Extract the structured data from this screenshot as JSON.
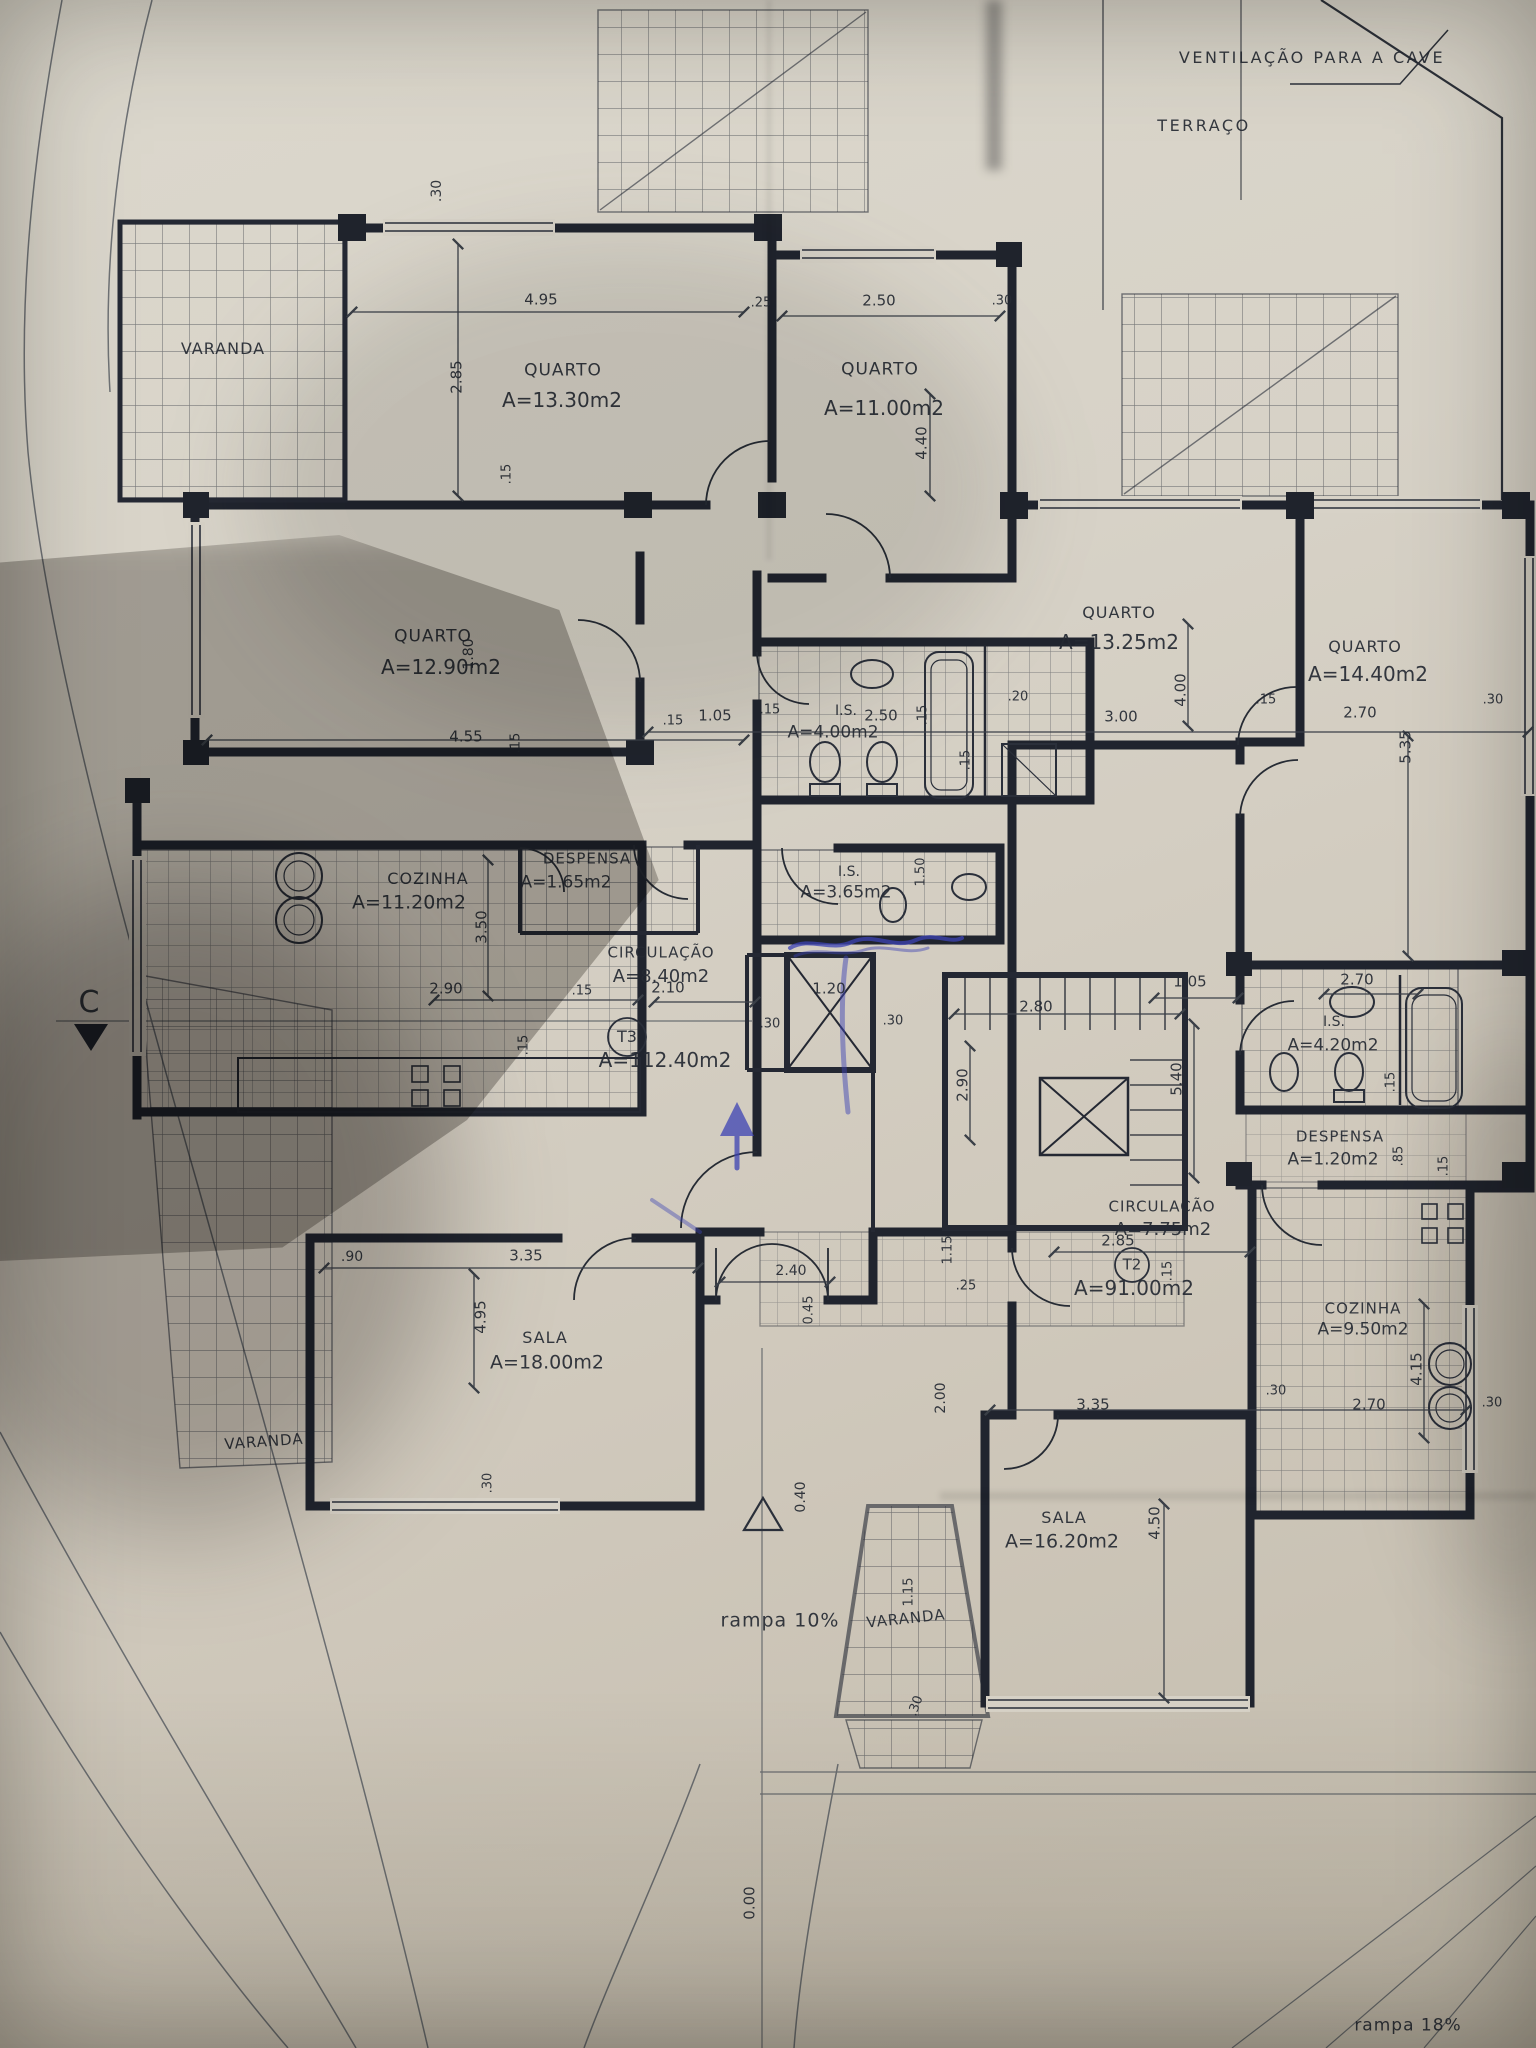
{
  "plan_summary": {
    "site_notes": [
      "VENTILAÇÃO PARA A CAVE",
      "TERRAÇO",
      "rampa 10%",
      "rampa 18%"
    ],
    "levels": [
      "0.40",
      "0.00"
    ],
    "section_marker": "C",
    "ink_annotation_color": "#3d43b4",
    "apartments": [
      {
        "tag": "T3",
        "total_area_m2": "112.40",
        "rooms": [
          {
            "name": "QUARTO",
            "area_m2": "13.30"
          },
          {
            "name": "QUARTO",
            "area_m2": "11.00"
          },
          {
            "name": "QUARTO",
            "area_m2": "12.90"
          },
          {
            "name": "COZINHA",
            "area_m2": "11.20"
          },
          {
            "name": "DESPENSA",
            "area_m2": "1.65"
          },
          {
            "name": "CIRCULAÇÃO",
            "area_m2": "8.40"
          },
          {
            "name": "I.S.",
            "area_m2": "4.00"
          },
          {
            "name": "I.S.",
            "area_m2": "3.65"
          },
          {
            "name": "SALA",
            "area_m2": "18.00"
          },
          {
            "name": "VARANDA",
            "area_m2": ""
          },
          {
            "name": "VARANDA",
            "area_m2": ""
          }
        ]
      },
      {
        "tag": "T2",
        "total_area_m2": "91.00",
        "rooms": [
          {
            "name": "QUARTO",
            "area_m2": "13.25"
          },
          {
            "name": "QUARTO",
            "area_m2": "14.40"
          },
          {
            "name": "I.S.",
            "area_m2": "4.20"
          },
          {
            "name": "DESPENSA",
            "area_m2": "1.20"
          },
          {
            "name": "CIRCULAÇÃO",
            "area_m2": "7.75"
          },
          {
            "name": "COZINHA",
            "area_m2": "9.50"
          },
          {
            "name": "SALA",
            "area_m2": "16.20"
          },
          {
            "name": "VARANDA",
            "area_m2": ""
          }
        ]
      }
    ]
  },
  "labels": [
    {
      "t": "VENTILAÇÃO PARA A CAVE",
      "x": 1312,
      "y": 58,
      "s": 16,
      "ls": 2.5,
      "n": "note-ventilacao-cave"
    },
    {
      "t": "TERRAÇO",
      "x": 1204,
      "y": 126,
      "s": 16,
      "ls": 2.5,
      "n": "note-terraco"
    },
    {
      "t": "C",
      "x": 89,
      "y": 1003,
      "s": 30,
      "n": "section-marker-c"
    },
    {
      "t": "rampa 10%",
      "x": 780,
      "y": 1621,
      "s": 19,
      "ls": 1,
      "n": "note-rampa-10"
    },
    {
      "t": "rampa 18%",
      "x": 1408,
      "y": 2026,
      "s": 17,
      "ls": 1,
      "n": "note-rampa-18"
    },
    {
      "t": "0.00",
      "x": 750,
      "y": 1903,
      "s": 15,
      "r": -90,
      "n": "level-0-00"
    },
    {
      "t": "0.40",
      "x": 801,
      "y": 1497,
      "s": 14,
      "r": -90,
      "n": "level-0-40"
    },
    {
      "t": "VARANDA",
      "x": 223,
      "y": 349,
      "s": 16,
      "ls": 1,
      "n": "room-varanda-topleft"
    },
    {
      "t": "VARANDA",
      "x": 264,
      "y": 1442,
      "s": 15,
      "ls": 1,
      "r": -4,
      "n": "room-varanda-bottomleft"
    },
    {
      "t": "VARANDA",
      "x": 906,
      "y": 1619,
      "s": 15,
      "ls": 1,
      "r": -6,
      "n": "room-varanda-center"
    },
    {
      "t": "QUARTO",
      "x": 563,
      "y": 371,
      "s": 17,
      "ls": 1,
      "n": "room-quarto-1330-name"
    },
    {
      "t": "A=13.30m2",
      "x": 562,
      "y": 400,
      "s": 20,
      "n": "room-quarto-1330-area"
    },
    {
      "t": "QUARTO",
      "x": 880,
      "y": 370,
      "s": 17,
      "ls": 1,
      "n": "room-quarto-1100-name"
    },
    {
      "t": "A=11.00m2",
      "x": 884,
      "y": 408,
      "s": 20,
      "n": "room-quarto-1100-area"
    },
    {
      "t": "QUARTO",
      "x": 433,
      "y": 637,
      "s": 17,
      "ls": 1,
      "n": "room-quarto-1290-name"
    },
    {
      "t": "A=12.90m2",
      "x": 441,
      "y": 667,
      "s": 20,
      "n": "room-quarto-1290-area"
    },
    {
      "t": "COZINHA",
      "x": 428,
      "y": 879,
      "s": 16,
      "ls": 1,
      "n": "room-cozinha-t3-name"
    },
    {
      "t": "A=11.20m2",
      "x": 409,
      "y": 903,
      "s": 19,
      "n": "room-cozinha-t3-area"
    },
    {
      "t": "DESPENSA",
      "x": 587,
      "y": 859,
      "s": 15,
      "ls": 1,
      "n": "room-despensa-t3-name"
    },
    {
      "t": "A=1.65m2",
      "x": 566,
      "y": 883,
      "s": 17,
      "n": "room-despensa-t3-area"
    },
    {
      "t": "CIRCULAÇÃO",
      "x": 661,
      "y": 953,
      "s": 15,
      "ls": 1,
      "n": "room-circulacao-t3-name"
    },
    {
      "t": "A=8.40m2",
      "x": 661,
      "y": 977,
      "s": 18,
      "n": "room-circulacao-t3-area"
    },
    {
      "t": "T3",
      "x": 627,
      "y": 1037,
      "s": 16,
      "n": "apartment-t3-tag"
    },
    {
      "t": "A=112.40m2",
      "x": 665,
      "y": 1060,
      "s": 20,
      "n": "apartment-t3-area"
    },
    {
      "t": "I.S.",
      "x": 846,
      "y": 711,
      "s": 14,
      "n": "room-is-400-name"
    },
    {
      "t": "2.50",
      "x": 881,
      "y": 716,
      "s": 15,
      "n": "dimension-label"
    },
    {
      "t": "A=4.00m2",
      "x": 833,
      "y": 733,
      "s": 17,
      "n": "room-is-400-area"
    },
    {
      "t": "I.S.",
      "x": 849,
      "y": 872,
      "s": 14,
      "n": "room-is-365-name"
    },
    {
      "t": "A=3.65m2",
      "x": 846,
      "y": 893,
      "s": 17,
      "n": "room-is-365-area"
    },
    {
      "t": "SALA",
      "x": 545,
      "y": 1338,
      "s": 16,
      "ls": 1,
      "n": "room-sala-t3-name"
    },
    {
      "t": "A=18.00m2",
      "x": 547,
      "y": 1363,
      "s": 19,
      "n": "room-sala-t3-area"
    },
    {
      "t": "QUARTO",
      "x": 1119,
      "y": 613,
      "s": 16,
      "ls": 1,
      "n": "room-quarto-1325-name"
    },
    {
      "t": "A=13.25m2",
      "x": 1119,
      "y": 642,
      "s": 20,
      "n": "room-quarto-1325-area"
    },
    {
      "t": "QUARTO",
      "x": 1365,
      "y": 647,
      "s": 16,
      "ls": 1,
      "n": "room-quarto-1440-name"
    },
    {
      "t": "A=14.40m2",
      "x": 1368,
      "y": 674,
      "s": 20,
      "n": "room-quarto-1440-area"
    },
    {
      "t": "I.S.",
      "x": 1334,
      "y": 1022,
      "s": 14,
      "n": "room-is-420-name"
    },
    {
      "t": "A=4.20m2",
      "x": 1333,
      "y": 1046,
      "s": 17,
      "n": "room-is-420-area"
    },
    {
      "t": "DESPENSA",
      "x": 1340,
      "y": 1137,
      "s": 15,
      "ls": 1,
      "n": "room-despensa-t2-name"
    },
    {
      "t": "A=1.20m2",
      "x": 1333,
      "y": 1160,
      "s": 17,
      "n": "room-despensa-t2-area"
    },
    {
      "t": "CIRCULAÇÃO",
      "x": 1162,
      "y": 1207,
      "s": 15,
      "ls": 1,
      "n": "room-circulacao-t2-name"
    },
    {
      "t": "A=7.75m2",
      "x": 1163,
      "y": 1230,
      "s": 18,
      "n": "room-circulacao-t2-area"
    },
    {
      "t": "2.85",
      "x": 1118,
      "y": 1241,
      "s": 15,
      "n": "dimension-label"
    },
    {
      "t": "T2",
      "x": 1132,
      "y": 1265,
      "s": 15,
      "n": "apartment-t2-tag"
    },
    {
      "t": "A=91.00m2",
      "x": 1134,
      "y": 1288,
      "s": 20,
      "n": "apartment-t2-area"
    },
    {
      "t": "COZINHA",
      "x": 1363,
      "y": 1309,
      "s": 15,
      "ls": 1,
      "n": "room-cozinha-t2-name"
    },
    {
      "t": "A=9.50m2",
      "x": 1363,
      "y": 1330,
      "s": 17,
      "n": "room-cozinha-t2-area"
    },
    {
      "t": "SALA",
      "x": 1064,
      "y": 1518,
      "s": 16,
      "ls": 1,
      "n": "room-sala-t2-name"
    },
    {
      "t": "A=16.20m2",
      "x": 1062,
      "y": 1542,
      "s": 19,
      "n": "room-sala-t2-area"
    },
    {
      "t": ".30",
      "x": 437,
      "y": 191,
      "s": 14,
      "r": -90
    },
    {
      "t": "4.95",
      "x": 541,
      "y": 300,
      "s": 15
    },
    {
      "t": "2.85",
      "x": 457,
      "y": 377,
      "s": 15,
      "r": -90
    },
    {
      "t": ".15",
      "x": 507,
      "y": 474,
      "s": 13,
      "r": -90
    },
    {
      "t": ".25",
      "x": 761,
      "y": 303,
      "s": 13
    },
    {
      "t": "2.50",
      "x": 879,
      "y": 301,
      "s": 15
    },
    {
      "t": ".30",
      "x": 1002,
      "y": 301,
      "s": 13
    },
    {
      "t": "4.40",
      "x": 922,
      "y": 443,
      "s": 15,
      "r": -90
    },
    {
      "t": "4.55",
      "x": 466,
      "y": 737,
      "s": 15
    },
    {
      "t": ".15",
      "x": 516,
      "y": 743,
      "s": 13,
      "r": -90
    },
    {
      "t": "1.80",
      "x": 469,
      "y": 654,
      "s": 14,
      "r": -90
    },
    {
      "t": ".15",
      "x": 673,
      "y": 721,
      "s": 13
    },
    {
      "t": "1.05",
      "x": 715,
      "y": 716,
      "s": 15
    },
    {
      "t": ".15",
      "x": 770,
      "y": 710,
      "s": 13
    },
    {
      "t": ".15",
      "x": 923,
      "y": 715,
      "s": 13,
      "r": -90
    },
    {
      "t": ".20",
      "x": 1018,
      "y": 697,
      "s": 13
    },
    {
      "t": ".15",
      "x": 966,
      "y": 760,
      "s": 13,
      "r": -90
    },
    {
      "t": "1.50",
      "x": 921,
      "y": 872,
      "s": 13,
      "r": -90
    },
    {
      "t": "3.00",
      "x": 1121,
      "y": 717,
      "s": 15
    },
    {
      "t": "4.00",
      "x": 1181,
      "y": 690,
      "s": 15,
      "r": -90
    },
    {
      "t": ".15",
      "x": 1266,
      "y": 700,
      "s": 13
    },
    {
      "t": "2.70",
      "x": 1360,
      "y": 713,
      "s": 15
    },
    {
      "t": "5.35",
      "x": 1406,
      "y": 747,
      "s": 15,
      "r": -90
    },
    {
      "t": ".30",
      "x": 1493,
      "y": 700,
      "s": 13
    },
    {
      "t": "2.90",
      "x": 446,
      "y": 989,
      "s": 15
    },
    {
      "t": ".15",
      "x": 582,
      "y": 991,
      "s": 13
    },
    {
      "t": "3.50",
      "x": 482,
      "y": 927,
      "s": 15,
      "r": -90
    },
    {
      "t": ".15",
      "x": 524,
      "y": 1045,
      "s": 13,
      "r": -90
    },
    {
      "t": "2.10",
      "x": 668,
      "y": 988,
      "s": 15
    },
    {
      "t": "1.20",
      "x": 829,
      "y": 989,
      "s": 15
    },
    {
      "t": ".30",
      "x": 770,
      "y": 1024,
      "s": 13
    },
    {
      "t": ".30",
      "x": 893,
      "y": 1021,
      "s": 13
    },
    {
      "t": "2.80",
      "x": 1036,
      "y": 1007,
      "s": 15
    },
    {
      "t": "2.90",
      "x": 963,
      "y": 1085,
      "s": 15,
      "r": -90
    },
    {
      "t": "5.40",
      "x": 1177,
      "y": 1079,
      "s": 15,
      "r": -90
    },
    {
      "t": "1.05",
      "x": 1190,
      "y": 982,
      "s": 15
    },
    {
      "t": "2.70",
      "x": 1357,
      "y": 980,
      "s": 15
    },
    {
      "t": ".15",
      "x": 1391,
      "y": 1082,
      "s": 13,
      "r": -90
    },
    {
      "t": ".85",
      "x": 1399,
      "y": 1156,
      "s": 13,
      "r": -90
    },
    {
      "t": ".15",
      "x": 1444,
      "y": 1166,
      "s": 13,
      "r": -90
    },
    {
      "t": ".15",
      "x": 1168,
      "y": 1271,
      "s": 13,
      "r": -90
    },
    {
      "t": "3.35",
      "x": 1093,
      "y": 1405,
      "s": 15
    },
    {
      "t": ".30",
      "x": 1276,
      "y": 1391,
      "s": 13
    },
    {
      "t": "2.70",
      "x": 1369,
      "y": 1405,
      "s": 15
    },
    {
      "t": "4.15",
      "x": 1417,
      "y": 1369,
      "s": 15,
      "r": -90
    },
    {
      "t": ".30",
      "x": 1492,
      "y": 1403,
      "s": 13
    },
    {
      "t": ".90",
      "x": 352,
      "y": 1257,
      "s": 14
    },
    {
      "t": "3.35",
      "x": 526,
      "y": 1256,
      "s": 15
    },
    {
      "t": "4.95",
      "x": 481,
      "y": 1317,
      "s": 15,
      "r": -90
    },
    {
      "t": ".30",
      "x": 488,
      "y": 1483,
      "s": 13,
      "r": -90
    },
    {
      "t": "2.40",
      "x": 791,
      "y": 1271,
      "s": 14
    },
    {
      "t": "0.45",
      "x": 809,
      "y": 1310,
      "s": 13,
      "r": -90
    },
    {
      "t": ".25",
      "x": 966,
      "y": 1286,
      "s": 13
    },
    {
      "t": "1.15",
      "x": 948,
      "y": 1250,
      "s": 13,
      "r": -90
    },
    {
      "t": "2.00",
      "x": 941,
      "y": 1398,
      "s": 14,
      "r": -90
    },
    {
      "t": "4.50",
      "x": 1155,
      "y": 1523,
      "s": 15,
      "r": -90
    },
    {
      "t": "1.15",
      "x": 909,
      "y": 1592,
      "s": 13,
      "r": -90
    },
    {
      "t": ".30",
      "x": 916,
      "y": 1706,
      "s": 13,
      "r": -70
    }
  ]
}
